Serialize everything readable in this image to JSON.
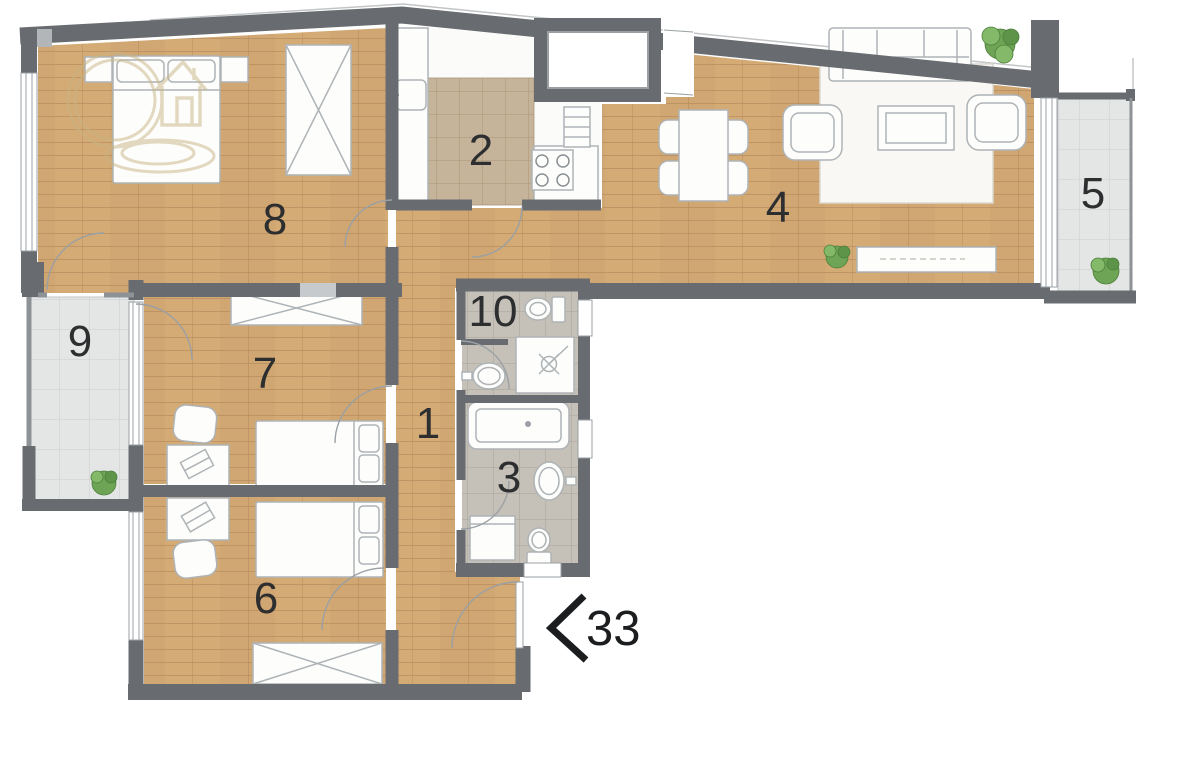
{
  "floorplan": {
    "room_labels": [
      "8",
      "2",
      "4",
      "5",
      "9",
      "7",
      "1",
      "10",
      "3",
      "6"
    ],
    "entrance": {
      "number": "33",
      "direction_icon": "chevron-left-icon"
    },
    "watermark_icon": "house-in-circle-logo",
    "colors": {
      "wall": "#686b6f",
      "wood_floor": "#d4aa75",
      "kitchen_tile": "#c6b49a",
      "bathroom_tile": "#c6c1b8",
      "balcony_tile": "#e4e6e5",
      "label_text": "#2c2e2f",
      "entrance_text": "#1b1d1e",
      "watermark_gold": "#c9b584",
      "furniture_fill": "#fdfdfc",
      "plant_green": "#6da455"
    }
  }
}
